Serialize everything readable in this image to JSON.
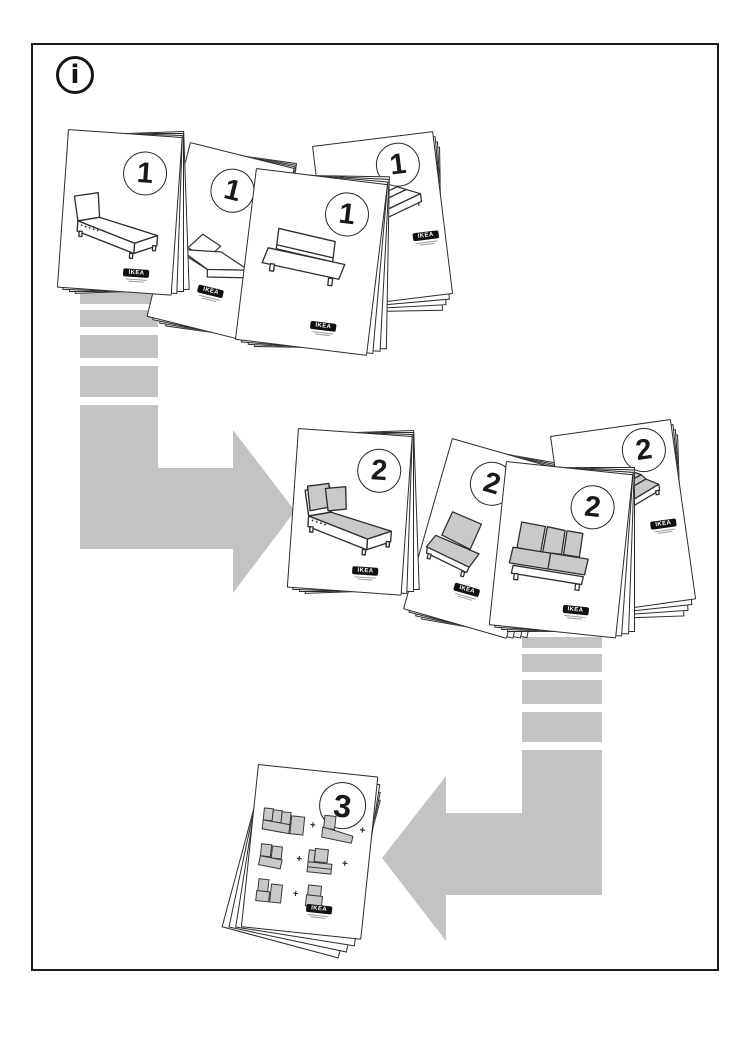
{
  "page": {
    "width": 750,
    "height": 1061
  },
  "colors": {
    "arrow": "#c3c3c3",
    "cushion": "#c9c9c9",
    "outline": "#2e2e2e",
    "paper": "#ffffff"
  },
  "info_icon": {
    "glyph": "i"
  },
  "steps": {
    "step1": {
      "booklets": [
        {
          "badge": "1",
          "logo": "IKEA",
          "illustration": "chaise-lounge-frame"
        },
        {
          "badge": "1",
          "logo": "IKEA",
          "illustration": "folded-seat-frame"
        },
        {
          "badge": "1",
          "logo": "IKEA",
          "illustration": "armless-sofa-frame"
        },
        {
          "badge": "1",
          "logo": "IKEA",
          "illustration": "sofa-frame-side-view"
        }
      ]
    },
    "step2": {
      "booklets": [
        {
          "badge": "2",
          "logo": "IKEA",
          "illustration": "chaise-lounge-with-cushions"
        },
        {
          "badge": "2",
          "logo": "IKEA",
          "illustration": "armless-seat-with-cushions"
        },
        {
          "badge": "2",
          "logo": "IKEA",
          "illustration": "loveseat-with-cushions"
        },
        {
          "badge": "2",
          "logo": "IKEA",
          "illustration": "sofa-with-cushions"
        }
      ]
    },
    "step3": {
      "booklet": {
        "badge": "3",
        "logo": "IKEA",
        "illustration": "module-combination-chart"
      },
      "plus": "+"
    }
  }
}
